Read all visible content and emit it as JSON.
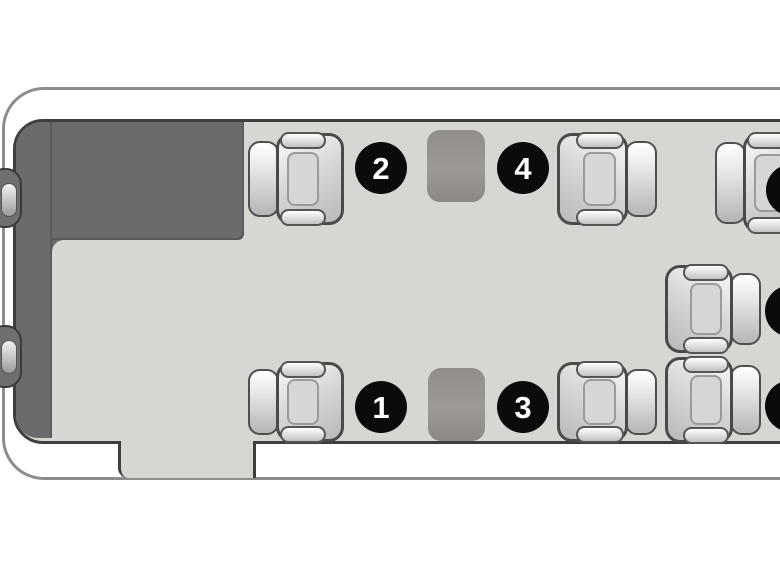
{
  "diagram": {
    "type": "aircraft-cabin-seat-map",
    "visible_seat_numbers": [
      "1",
      "2",
      "3",
      "4"
    ],
    "badge_radius": 26,
    "colors": {
      "background": "#ffffff",
      "fuselage_line": "#8d8d8d",
      "cabin_floor": "#d8d6d3",
      "cabin_outline": "#3e3e3e",
      "bulkhead": "#6b6b6b",
      "table": "#98948f",
      "seat_outline": "#4a4a4a",
      "badge_background": "#0b0b0b",
      "badge_text": "#ffffff"
    },
    "seats": [
      {
        "id": "seat-2",
        "badge": "2",
        "facing": "right",
        "x": 248,
        "y": 133,
        "w": 96,
        "h": 92,
        "badge_x": 381,
        "badge_y": 168
      },
      {
        "id": "seat-4",
        "badge": "4",
        "facing": "left",
        "x": 557,
        "y": 133,
        "w": 100,
        "h": 92,
        "badge_x": 523,
        "badge_y": 168
      },
      {
        "id": "seat-right-forward",
        "badge": "",
        "facing": "right",
        "x": 715,
        "y": 133,
        "w": 96,
        "h": 100,
        "badge_x": 792,
        "badge_y": 190
      },
      {
        "id": "seat-1",
        "badge": "1",
        "facing": "right",
        "x": 248,
        "y": 362,
        "w": 96,
        "h": 80,
        "badge_x": 381,
        "badge_y": 407
      },
      {
        "id": "seat-3",
        "badge": "3",
        "facing": "left",
        "x": 557,
        "y": 362,
        "w": 100,
        "h": 80,
        "badge_x": 523,
        "badge_y": 407
      },
      {
        "id": "seat-right-mid",
        "badge": "",
        "facing": "left",
        "x": 665,
        "y": 265,
        "w": 96,
        "h": 88,
        "badge_x": 791,
        "badge_y": 311
      },
      {
        "id": "seat-right-aft",
        "badge": "",
        "facing": "left",
        "x": 665,
        "y": 357,
        "w": 96,
        "h": 86,
        "badge_x": 791,
        "badge_y": 406
      }
    ],
    "tables": [
      {
        "id": "table-forward",
        "x": 427,
        "y": 130,
        "w": 58,
        "h": 72
      },
      {
        "id": "table-aft",
        "x": 428,
        "y": 368,
        "w": 57,
        "h": 73
      }
    ],
    "cockpit_bumps": [
      {
        "id": "cockpit-seat-bump-upper",
        "y": 168,
        "h": 60
      },
      {
        "id": "cockpit-seat-bump-lower",
        "y": 325,
        "h": 63
      }
    ]
  }
}
